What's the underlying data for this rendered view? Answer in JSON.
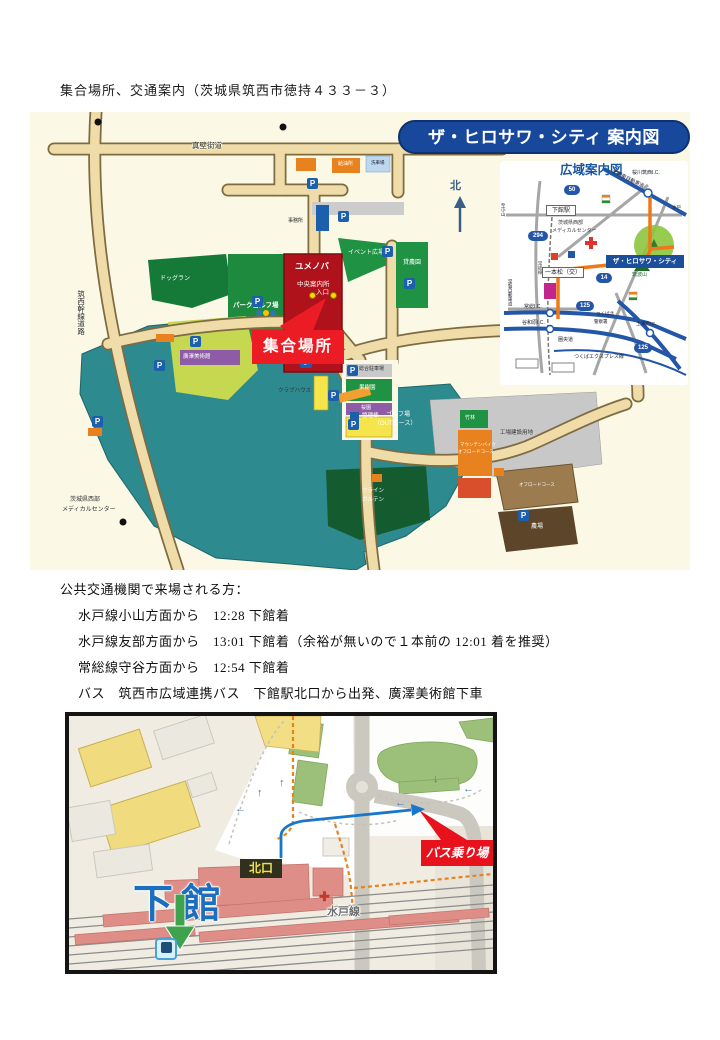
{
  "page": {
    "heading": "集合場所、交通案内（茨城県筑西市徳持４３３－３）"
  },
  "icons": {
    "parking": "P",
    "wheelchair": "♿",
    "cross": "✚",
    "north_arrow": "↑",
    "arrow_left": "←",
    "arrow_up": "↑",
    "arrow_down": "↓"
  },
  "main_map": {
    "title": "ザ・ヒロサワ・シティ 案内図",
    "north": "北",
    "road_makabe": "真壁街道",
    "road_chikusei": "筑西幹線道路",
    "yumenoba": "ユメノバ",
    "chuo_annaijo": "中央案内所",
    "iriguchi": "入口",
    "jimusho": "事務所",
    "kyuyujo": "給油所",
    "senshajo": "洗車場",
    "park_golf": "パークゴルフ場",
    "dog_run": "ドッグラン",
    "event_hiroba": "イベント広場",
    "kashinoen": "貸農園",
    "sogo_parking": "総合駐車場",
    "kajuen": "果樹園",
    "sakuraen": "桜園",
    "museum": "廣澤美術館",
    "clubhouse": "クラブハウス",
    "kanrito": "管理棟",
    "golf1": "ゴルフ場",
    "golf2": "（OUTコース）",
    "chikurin": "竹林",
    "mtb1": "マウンテンバイク",
    "mtb2": "オフロードコース",
    "yochi": "工場建設用地",
    "offroad": "オフロードコース",
    "klein1": "クライン",
    "klein2": "ガルテン",
    "nojo": "農場",
    "medical1": "茨城県西部",
    "medical2": "メディカルセンター",
    "meeting": "集合場所"
  },
  "inset": {
    "title": "広域案内図",
    "hirosawa_city": "ザ・ヒロサワ・シティ",
    "shimodate_sta": "下館駅",
    "ipponmatsu": "一本松（交）",
    "sakuragawa_ic": "桜川筑西I.C.",
    "kitakanto": "北関東自動車道",
    "medical1": "茨城県西部",
    "medical2": "メディカルセンター",
    "tsukubasan": "筑波山",
    "joso_ic": "常総I.C.",
    "yawara_ic": "谷和原I.C.",
    "joban": "常磐自動車道",
    "kenodo": "圏央道",
    "tx": "つくばエクスプレス線",
    "tsuchiura_ic": "土浦北I.C.",
    "police1": "つくば北",
    "police2": "警察署",
    "mito": "水戸",
    "oyama": "至小山",
    "josoline": "常総線",
    "shields": [
      "50",
      "294",
      "14",
      "125",
      "125"
    ]
  },
  "transport": {
    "lines": [
      "公共交通機関で来場される方：",
      "水戸線小山方面から　12:28 下館着",
      "水戸線友部方面から　13:01 下館着（余裕が無いので１本前の 12:01 着を推奨）",
      "常総線守谷方面から　12:54 下館着",
      "バス　筑西市広域連携バス　下館駅北口から出発、廣澤美術館下車",
      "下館駅北口 13:05 発　→廣澤美術館 13:17 着"
    ]
  },
  "station_map": {
    "shimodate": "下館",
    "kitaguchi": "北口",
    "mito_line": "水戸線",
    "bus_stop": "バス乗り場"
  }
}
